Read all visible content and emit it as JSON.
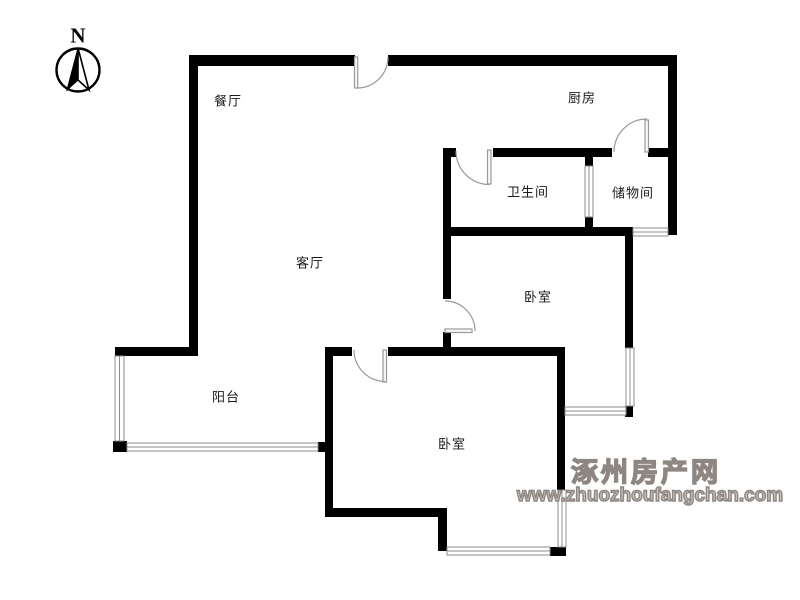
{
  "compass": {
    "label": "N"
  },
  "rooms": {
    "dining": {
      "label": "餐厅"
    },
    "kitchen": {
      "label": "厨房"
    },
    "bathroom": {
      "label": "卫生间"
    },
    "storage": {
      "label": "储物间"
    },
    "living": {
      "label": "客厅"
    },
    "bedroom_upper": {
      "label": "卧室"
    },
    "balcony": {
      "label": "阳台"
    },
    "bedroom_lower": {
      "label": "卧室"
    }
  },
  "watermark": {
    "site_name": "涿州房产网",
    "site_url": "www.zhuozhoufangchan.com"
  },
  "colors": {
    "wall": "#000000",
    "window_frame": "#8c8c8c",
    "door": "#9a9a9a",
    "label_text": "#1a1a1a",
    "watermark_text": "#8d8681",
    "background": "#ffffff"
  }
}
